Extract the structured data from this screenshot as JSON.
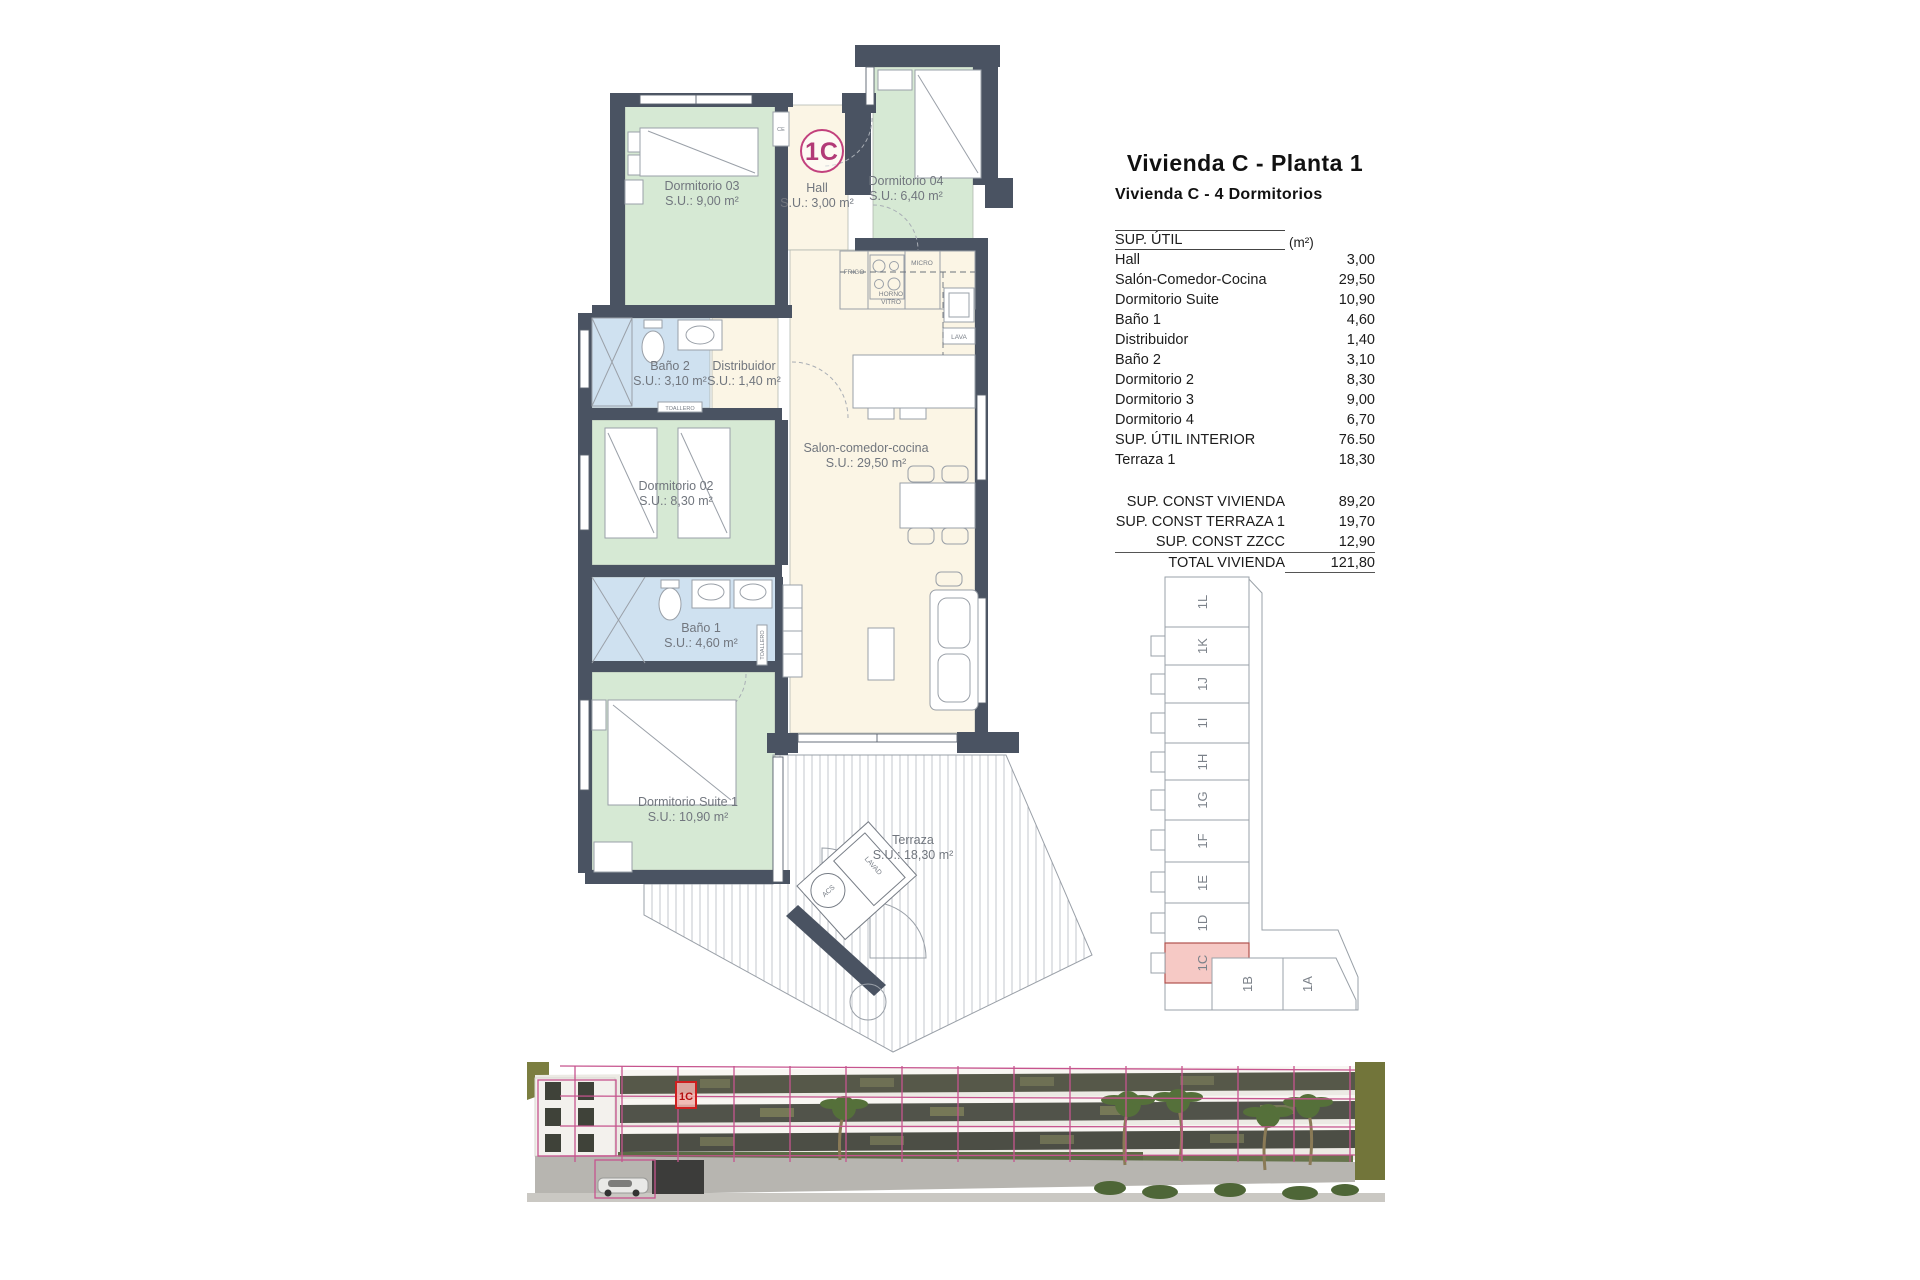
{
  "title": "Vivienda C - Planta 1",
  "subtitle": "Vivienda C - 4 Dormitorios",
  "area_table": {
    "header_label": "SUP. ÚTIL",
    "header_unit": "(m²)",
    "rows": [
      {
        "label": "Hall",
        "value": "3,00"
      },
      {
        "label": "Salón-Comedor-Cocina",
        "value": "29,50"
      },
      {
        "label": "Dormitorio Suite",
        "value": "10,90"
      },
      {
        "label": "Baño 1",
        "value": "4,60"
      },
      {
        "label": "Distribuidor",
        "value": "1,40"
      },
      {
        "label": "Baño 2",
        "value": "3,10"
      },
      {
        "label": "Dormitorio 2",
        "value": "8,30"
      },
      {
        "label": "Dormitorio 3",
        "value": "9,00"
      },
      {
        "label": "Dormitorio 4",
        "value": "6,70"
      },
      {
        "label": "SUP. ÚTIL INTERIOR",
        "value": "76.50"
      },
      {
        "label": "Terraza 1",
        "value": "18,30"
      }
    ],
    "totals": [
      {
        "label": "SUP. CONST VIVIENDA",
        "value": "89,20"
      },
      {
        "label": "SUP. CONST TERRAZA 1",
        "value": "19,70"
      },
      {
        "label": "SUP. CONST ZZCC",
        "value": "12,90"
      },
      {
        "label": "TOTAL VIVIENDA",
        "value": "121,80"
      }
    ]
  },
  "floorplan": {
    "unit_badge": "1C",
    "rooms": [
      {
        "name": "Dormitorio 03",
        "area": "S.U.: 9,00 m²"
      },
      {
        "name": "Hall",
        "area": "S.U.: 3,00 m²"
      },
      {
        "name": "Dormitorio 04",
        "area": "S.U.: 6,40 m²"
      },
      {
        "name": "Baño 2",
        "area": "S.U.: 3,10 m²"
      },
      {
        "name": "Distribuidor",
        "area": "S.U.: 1,40 m²"
      },
      {
        "name": "Dormitorio 02",
        "area": "S.U.: 8,30 m²"
      },
      {
        "name": "Salon-comedor-cocina",
        "area": "S.U.: 29,50 m²"
      },
      {
        "name": "Baño 1",
        "area": "S.U.: 4,60 m²"
      },
      {
        "name": "Dormitorio Suite 1",
        "area": "S.U.: 10,90 m²"
      },
      {
        "name": "Terraza",
        "area": "S.U.: 18,30 m²"
      }
    ],
    "fixtures": {
      "frigo": "FRIGO",
      "micro": "MICRO",
      "horno1": "HORNO",
      "horno2": "VITRO",
      "lava": "LAVA",
      "toallero": "TOALLERO",
      "ce": "CE",
      "acs": "ACS",
      "lavad": "LAVAD"
    }
  },
  "keyplan": {
    "units": [
      "1L",
      "1K",
      "1J",
      "1I",
      "1H",
      "1G",
      "1F",
      "1E",
      "1D",
      "1C",
      "1B",
      "1A"
    ],
    "highlighted_unit": "1C"
  },
  "render": {
    "highlight_label": "1C"
  },
  "colors": {
    "accent_pink": "#c2417d",
    "wall": "#4a5362",
    "room_green": "#d6e9d4",
    "room_blue": "#cfe1f0",
    "room_cream": "#fbf5e5",
    "highlight_red": "#cf1f1f",
    "keyplan_highlight": "#f6c9c5"
  }
}
